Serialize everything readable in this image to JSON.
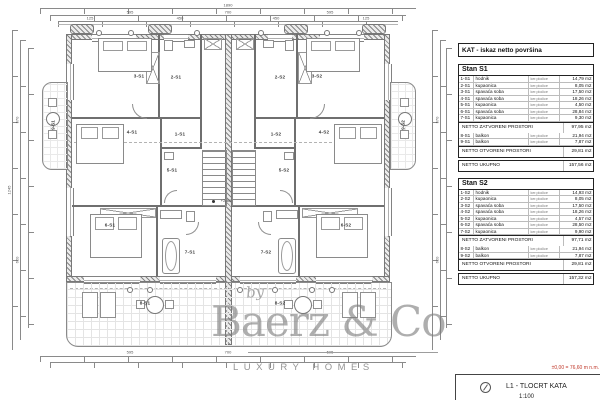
{
  "table": {
    "title": "KAT - iskaz netto površina",
    "sections": [
      {
        "name": "Stan S1",
        "rows": [
          {
            "code": "1-S1",
            "room": "hodnik",
            "finish": "ker.pločice",
            "area": "14,79 m2"
          },
          {
            "code": "2-S1",
            "room": "kupaonica",
            "finish": "ker.pločice",
            "area": "8,05 m2"
          },
          {
            "code": "3-S1",
            "room": "spavaća soba",
            "finish": "ker.pločice",
            "area": "17,50 m2"
          },
          {
            "code": "4-S1",
            "room": "spavaća soba",
            "finish": "ker.pločice",
            "area": "18,26 m2"
          },
          {
            "code": "5-S1",
            "room": "kupaonica",
            "finish": "ker.pločice",
            "area": "4,50 m2"
          },
          {
            "code": "6-S1",
            "room": "spavaća soba",
            "finish": "ker.pločice",
            "area": "28,84 m2"
          },
          {
            "code": "7-S1",
            "room": "kupaonica",
            "finish": "ker.pločice",
            "area": "9,30 m2"
          }
        ],
        "closed_label": "NETTO ZATVORENI PROSTORI",
        "closed_area": "97,95 m2",
        "open_rows": [
          {
            "code": "8-S1",
            "room": "balkon",
            "finish": "ker.pločice",
            "area": "21,94 m2"
          },
          {
            "code": "9-S1",
            "room": "balkon",
            "finish": "ker.pločice",
            "area": "7,87 m2"
          }
        ],
        "open_label": "NETTO OTVORENI PROSTORI",
        "open_area": "29,81 m2",
        "total_label": "NETTO UKUPNO",
        "total_area": "157,56 m2"
      },
      {
        "name": "Stan S2",
        "rows": [
          {
            "code": "1-S2",
            "room": "hodnik",
            "finish": "ker.pločice",
            "area": "14,93 m2"
          },
          {
            "code": "2-S2",
            "room": "kupaonica",
            "finish": "ker.pločice",
            "area": "8,05 m2"
          },
          {
            "code": "3-S2",
            "room": "spavaća soba",
            "finish": "ker.pločice",
            "area": "17,50 m2"
          },
          {
            "code": "4-S2",
            "room": "spavaća soba",
            "finish": "ker.pločice",
            "area": "18,26 m2"
          },
          {
            "code": "5-S2",
            "room": "kupaonica",
            "finish": "ker.pločice",
            "area": "4,57 m2"
          },
          {
            "code": "6-S2",
            "room": "spavaća soba",
            "finish": "ker.pločice",
            "area": "28,50 m2"
          },
          {
            "code": "7-S2",
            "room": "kupaonica",
            "finish": "ker.pločice",
            "area": "9,90 m2"
          }
        ],
        "closed_label": "NETTO ZATVORENI PROSTORI",
        "closed_area": "97,71 m2",
        "open_rows": [
          {
            "code": "8-S2",
            "room": "balkon",
            "finish": "ker.pločice",
            "area": "21,94 m2"
          },
          {
            "code": "9-S2",
            "room": "balkon",
            "finish": "ker.pločice",
            "area": "7,87 m2"
          }
        ],
        "open_label": "NETTO OTVORENI PROSTORI",
        "open_area": "29,81 m2",
        "total_label": "NETTO UKUPNO",
        "total_area": "157,32 m2"
      }
    ]
  },
  "plan": {
    "labels": {
      "r3s1": "3-S1",
      "r2s1": "2-S1",
      "r2s2": "2-S2",
      "r3s2": "3-S2",
      "r4s1": "4-S1",
      "r4s2": "4-S2",
      "r9s1": "9-S1",
      "r9s2": "9-S2",
      "r5s1": "5-S1",
      "r1s1": "1-S1",
      "r1s2": "1-S2",
      "r5s2": "5-S2",
      "r6s1": "6-S1",
      "r6s2": "6-S2",
      "r7s1": "7-S1",
      "r7s2": "7-S2",
      "r8s1": "8-S1",
      "r8s2": "8-S2"
    },
    "level_marker": "+2,80",
    "dims": {
      "top_total": "1890",
      "top_l": "595",
      "top_c": "700",
      "top_r": "595",
      "seg_a": "125",
      "seg_b": "450",
      "seg_c": "450",
      "seg_d": "125",
      "side_total": "1245",
      "side_a": "570",
      "side_b": "620",
      "bot_l": "595",
      "bot_c": "700",
      "bot_r": "595"
    }
  },
  "watermark": {
    "by": "by",
    "brand": "Baerz & Co",
    "tagline": "LUXURY HOMES"
  },
  "titleblock": {
    "level_note": "±0,00 = 76,60 m n.m.",
    "drawing_title": "L1 - TLOCRT KATA",
    "scale": "1:100"
  }
}
